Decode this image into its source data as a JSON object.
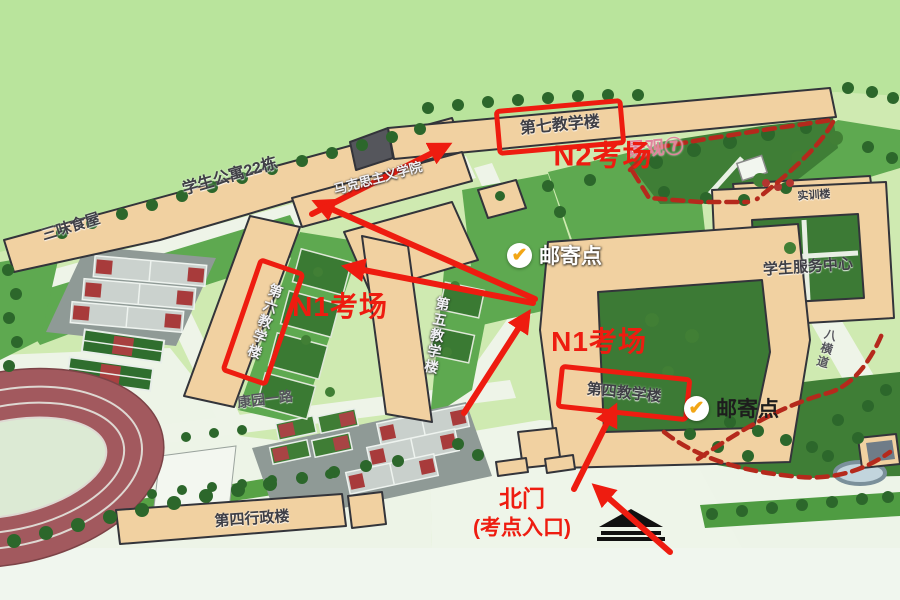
{
  "map": {
    "buildings": {
      "sanwei_restaurant": "三味食屋",
      "dorm_22": "学生公寓22栋",
      "teaching_7": "第七教学楼",
      "marxism_school": "马克思主义学院",
      "teaching_6": "第六教学楼",
      "teaching_5": "第五教学楼",
      "training_bldg": "实训楼",
      "student_services": "学生服务中心",
      "teaching_4": "第四教学楼",
      "admin_4": "第四行政楼"
    },
    "roads": {
      "kangyuan_rd": "康园一路",
      "baheng_rd": "八横道"
    },
    "landscape_7": "景观⑦"
  },
  "annotations": {
    "n2_room": "N2考场",
    "n1_room_west": "N1考场",
    "n1_room_east": "N1考场",
    "mail_west": "邮寄点",
    "mail_east": "邮寄点",
    "gate_line1": "北门",
    "gate_line2": "(考点入口)",
    "check": "✔"
  },
  "colors": {
    "annotation_red": "#ee1c10",
    "dashed_path_red": "#b5291c",
    "check_orange": "#f2a616",
    "landscape_label_pink": "#e0849c",
    "building_tan": "#f1d1a1",
    "lawn_green": "#5ea950",
    "dark_green": "#3c7a35",
    "track_red": "#a2595e"
  }
}
